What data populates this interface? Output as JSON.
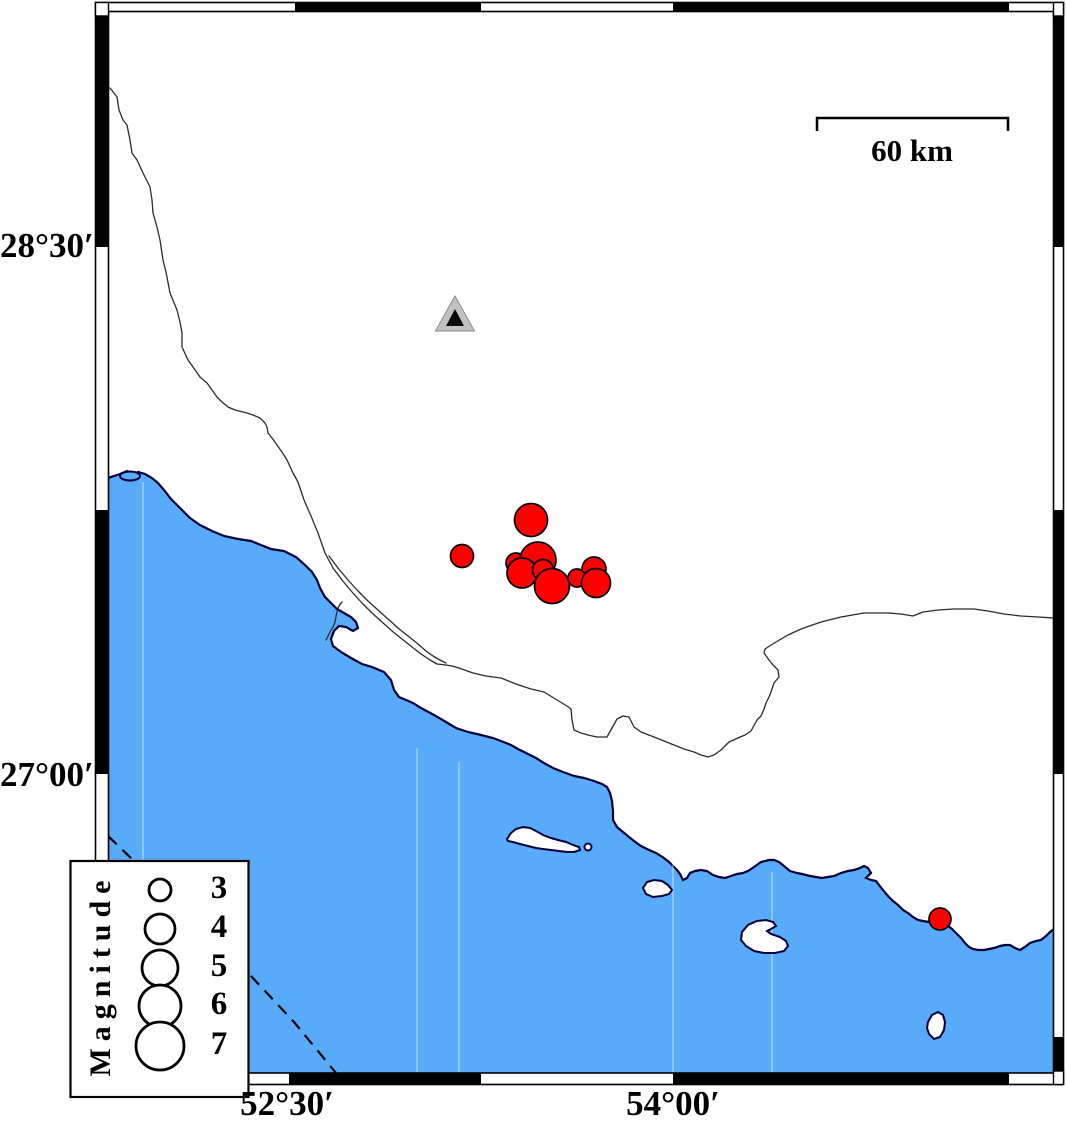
{
  "map": {
    "type": "earthquake-epicenter-map",
    "axis": {
      "left_labels": [
        {
          "text": "28°30′",
          "y_px": 247
        },
        {
          "text": "27°00′",
          "y_px": 776
        }
      ],
      "bottom_labels": [
        {
          "text": "52°30′",
          "x_px": 287
        },
        {
          "text": "54°00′",
          "x_px": 673
        }
      ]
    },
    "scale_bar": {
      "label": "60 km",
      "x1_px": 817,
      "x2_px": 1008,
      "y_px": 118
    },
    "legend": {
      "title": "Magnitude",
      "circle_cx_px": 160,
      "entries": [
        {
          "magnitude": "3",
          "radius_px": 11,
          "cy_px": 890
        },
        {
          "magnitude": "4",
          "radius_px": 15,
          "cy_px": 929
        },
        {
          "magnitude": "5",
          "radius_px": 18,
          "cy_px": 968
        },
        {
          "magnitude": "6",
          "radius_px": 21,
          "cy_px": 1006
        },
        {
          "magnitude": "7",
          "radius_px": 24,
          "cy_px": 1046
        }
      ]
    },
    "station_marker": {
      "shape": "triangle",
      "x_px": 455,
      "y_px": 318
    },
    "epicenters": [
      {
        "x_px": 462,
        "y_px": 556,
        "radius_px": 11.5,
        "approx_magnitude": 3.1
      },
      {
        "x_px": 531,
        "y_px": 520,
        "radius_px": 16.5,
        "approx_magnitude": 4.6
      },
      {
        "x_px": 516,
        "y_px": 563,
        "radius_px": 10,
        "approx_magnitude": 2.7
      },
      {
        "x_px": 538,
        "y_px": 560,
        "radius_px": 18,
        "approx_magnitude": 5.0
      },
      {
        "x_px": 522,
        "y_px": 573,
        "radius_px": 15,
        "approx_magnitude": 4.2
      },
      {
        "x_px": 543,
        "y_px": 570,
        "radius_px": 10.5,
        "approx_magnitude": 2.9
      },
      {
        "x_px": 552,
        "y_px": 586,
        "radius_px": 17.5,
        "approx_magnitude": 4.9
      },
      {
        "x_px": 594,
        "y_px": 569,
        "radius_px": 12,
        "approx_magnitude": 3.3
      },
      {
        "x_px": 577,
        "y_px": 578,
        "radius_px": 9,
        "approx_magnitude": 2.4
      },
      {
        "x_px": 596,
        "y_px": 583,
        "radius_px": 14.5,
        "approx_magnitude": 4.0
      },
      {
        "x_px": 940,
        "y_px": 919,
        "radius_px": 11,
        "approx_magnitude": 3.0
      }
    ],
    "colors": {
      "sea": "#58abf8",
      "coastline": "#000038",
      "epicenter_fill": "#ff0000",
      "station_fill": "#c2c2c2",
      "land": "#ffffff"
    }
  }
}
